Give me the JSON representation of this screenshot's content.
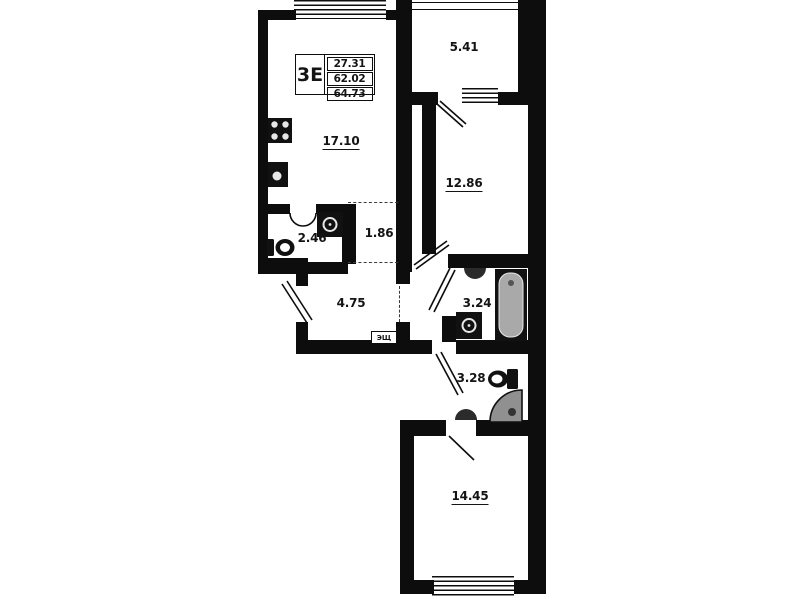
{
  "floorplan": {
    "unit": {
      "type_label": "3Е",
      "stats": [
        "27.31",
        "62.02",
        "64.73"
      ]
    },
    "rooms": [
      {
        "name": "loggia",
        "area": "5.41"
      },
      {
        "name": "kitchen-living",
        "area": "17.10"
      },
      {
        "name": "bedroom-1",
        "area": "12.86"
      },
      {
        "name": "bathroom-small",
        "area": "2.46"
      },
      {
        "name": "wardrobe",
        "area": "1.86"
      },
      {
        "name": "hallway",
        "area": "4.75"
      },
      {
        "name": "bathroom",
        "area": "3.24"
      },
      {
        "name": "wc-shower",
        "area": "3.28"
      },
      {
        "name": "bedroom-2",
        "area": "14.45"
      }
    ],
    "electrical_panel_label": "ЭЩ",
    "colors": {
      "wall": "#0d0d0d",
      "fixture": "#111111",
      "shower_fill": "#909090",
      "tub_fill": "#a9a9a9"
    }
  }
}
